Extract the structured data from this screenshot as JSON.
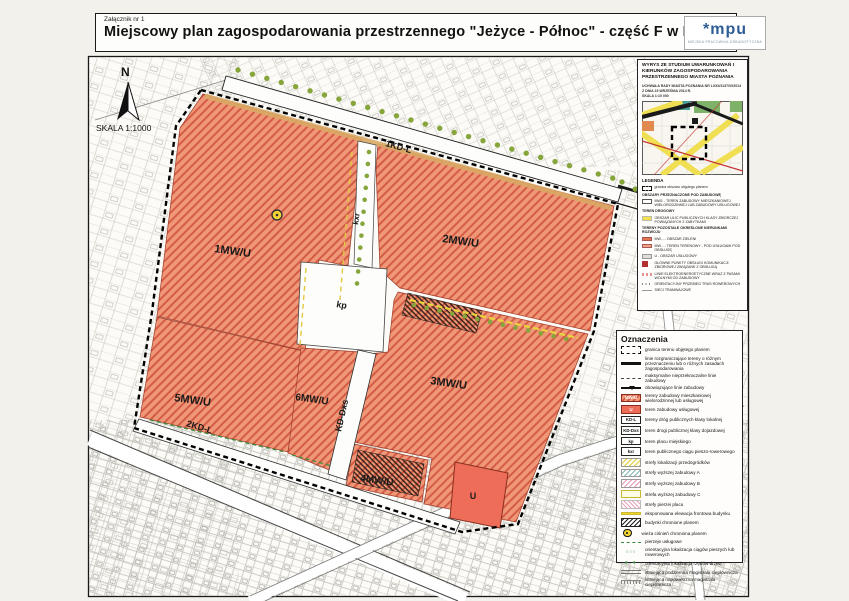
{
  "header": {
    "attachment": "Załącznik nr 1",
    "title": "Miejscowy plan zagospodarowania przestrzennego \"Jeżyce - Północ\" - część F  w Poznaniu",
    "logo": "*mpu",
    "logo_sub": "MIEJSKA PRACOWNIA URBANISTYCZNA"
  },
  "compass": {
    "north": "N",
    "scale": "SKALA 1:1000"
  },
  "map": {
    "labels": {
      "street_top": "1KD-L",
      "street_bottom": "2KD-L",
      "street_kddxs": "KD-Dxs",
      "kxr": "kxr",
      "kp": "kp",
      "b1": "1MW/U",
      "b2": "2MW/U",
      "b3": "3MW/U",
      "b4": "4MW/U",
      "b5": "5MW/U",
      "b6": "6MW/U",
      "u": "U"
    }
  },
  "inset": {
    "title": "WYRYS ZE STUDIUM UWARUNKOWAŃ I KIERUNKÓW ZAGOSPODAROWANIA PRZESTRZENNEGO MIASTA POZNANIA",
    "subtitle": "UCHWAŁA RADY MIASTA POZNANIA NR LXXII/1137/VI/2014 Z DNIA 23 WRZEŚNIA 2014 R.",
    "scale": "SKALA 1:10 000",
    "legend_title": "LEGENDA",
    "items": [
      {
        "icon": "i-dash",
        "label": "granica obszaru objętego planem"
      },
      {
        "icon": "i-sec",
        "label": "OBSZARY PRZEZNACZONE POD ZABUDOWĘ"
      },
      {
        "icon": "i-outline",
        "label": "MW1 - TEREN ZABUDOWY MIESZKANIOWEJ WIELORODZINNEJ LUB ZABUDOWY USŁUGOWEJ"
      },
      {
        "icon": "i-sec",
        "label": "TEREN DROGOWY"
      },
      {
        "icon": "i-yellow",
        "label": "OBSZAR ULIC PUBLICZNYCH KLASY ZBIORCZEJ POWIĄZANYCH Z ZABYTKAMI"
      },
      {
        "icon": "i-sec",
        "label": "TERENY POZOSTAŁE OKREŚLONE KIERUNKAMI ROZWOJU"
      },
      {
        "icon": "i-orange",
        "label": "MW... - OBSZAR ZIELENI"
      },
      {
        "icon": "i-salmon",
        "label": "MW... - TEREN TERENOWY - POD USŁUGAMI POD OBSŁUGĘ"
      },
      {
        "icon": "i-gray",
        "label": "U - OBSZAR USŁUGOWY"
      },
      {
        "icon": "i-red",
        "label": "GŁÓWNE PUNKTY OBSŁUGI KOMUNIKACJI ZBIOROWEJ ZWIĄZANE Z OBSŁUGĄ"
      },
      {
        "icon": "i-pink",
        "label": "LINIE ELEKTROENERGETYCZNE WRAZ Z PASAMI WOLNYMI OD ZABUDOWY"
      },
      {
        "icon": "i-dots",
        "label": "ORIENTACYJNY PRZEBIEG TRAS ROWEROWYCH"
      },
      {
        "icon": "i-line",
        "label": "SIECI TRAMWAJOWE"
      }
    ]
  },
  "legend": {
    "title": "Oznaczenia",
    "items": [
      {
        "icon": "boundary",
        "label": "granica terenu objętego planem"
      },
      {
        "icon": "line-thick",
        "label": "linie rozgraniczające tereny o różnym przeznaczeniu lub o różnych zasadach zagospodarowania"
      },
      {
        "icon": "line-dashdot",
        "label": "maksymalne nieprzekraczalne linie zabudowy"
      },
      {
        "icon": "line-triangle",
        "label": "obowiązujące linie zabudowy"
      },
      {
        "icon": "swatch-mwu",
        "code": "MW/U",
        "label": "tereny zabudowy mieszkaniowej wielorodzinnej lub usługowej"
      },
      {
        "icon": "swatch-u",
        "code": "U",
        "label": "teren zabudowy usługowej"
      },
      {
        "icon": "code",
        "code": "KD-L",
        "label": "tereny dróg publicznych klasy lokalnej"
      },
      {
        "icon": "code",
        "code": "KD-Dxs",
        "label": "teren drogi publicznej klasy dojazdowej"
      },
      {
        "icon": "code",
        "code": "kp",
        "label": "teren placu miejskiego"
      },
      {
        "icon": "code",
        "code": "kxr",
        "label": "teren publicznego ciągu pieszo-rowerowego"
      },
      {
        "icon": "hatch-yellow",
        "label": "strefy lokalizacji przedogródków"
      },
      {
        "icon": "hatch-teal",
        "label": "strefy wyższej zabudowy A"
      },
      {
        "icon": "hatch-pink",
        "label": "strefy wyższej zabudowy B"
      },
      {
        "icon": "swatch-outline-yellow",
        "label": "strefa wyższej zabudowy C"
      },
      {
        "icon": "hatch-rose",
        "label": "strefy pierzei placu"
      },
      {
        "icon": "line-yellow",
        "label": "eksponowana elewacja frontowa budynku"
      },
      {
        "icon": "hatch-black",
        "label": "budynki chronione planem"
      },
      {
        "icon": "tower",
        "label": "wieża ciśnień chroniona planem"
      },
      {
        "icon": "dash-green",
        "label": "pierzeje usługowe"
      },
      {
        "icon": "dots-open",
        "label": "orientacyjna lokalizacja ciągów pieszych lub rowerowych"
      },
      {
        "icon": "dots-green",
        "label": "orientacyjna lokalizacja rzędów drzew"
      },
      {
        "icon": "line-double",
        "label": "istniejąca podziemna magistrala ciepłownicza"
      },
      {
        "icon": "line-ticked",
        "label": "istniejąca napowietrzna magistrala ciepłownicza"
      }
    ]
  },
  "colors": {
    "block_orange": "#ef9776",
    "hatch_red": "#cd4e3a",
    "u_red": "#ee6d58",
    "tree_green": "#86a53b",
    "logo_blue": "#2d5d94",
    "accent_yellow": "#f2d435"
  }
}
